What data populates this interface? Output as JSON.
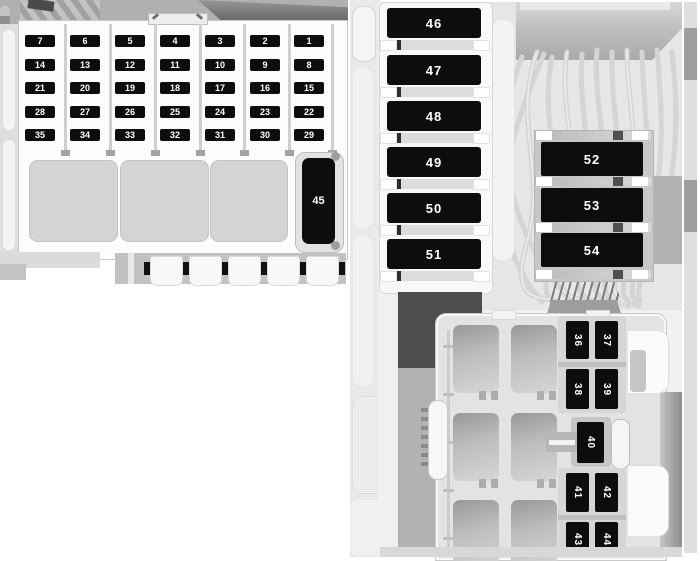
{
  "diagram": {
    "left_block": {
      "fuse_rows": [
        [
          "7",
          "6",
          "5",
          "4",
          "3",
          "2",
          "1"
        ],
        [
          "14",
          "13",
          "12",
          "11",
          "10",
          "9",
          "8"
        ],
        [
          "21",
          "20",
          "19",
          "18",
          "17",
          "16",
          "15"
        ],
        [
          "28",
          "27",
          "26",
          "25",
          "24",
          "23",
          "22"
        ],
        [
          "35",
          "34",
          "33",
          "32",
          "31",
          "30",
          "29"
        ]
      ],
      "large_fuse": "45"
    },
    "right_block": {
      "column_fuses": [
        "46",
        "47",
        "48",
        "49",
        "50",
        "51"
      ],
      "bracket_fuses": [
        "52",
        "53",
        "54"
      ],
      "mini_fuses_upper": [
        "36",
        "37",
        "38",
        "39"
      ],
      "mini_fuse_middle": "40",
      "mini_fuses_lower": [
        "41",
        "42",
        "43",
        "44"
      ]
    },
    "colors": {
      "fuse_body": "#0d0d0d",
      "fuse_text": "#ffffff",
      "panel_light": "#f0f0f0",
      "panel_mid": "#c6c6c6",
      "panel_dark": "#4d4d4d",
      "relay_gray": "#b5b5b5",
      "wire_gray": "#d4d4d4"
    }
  }
}
